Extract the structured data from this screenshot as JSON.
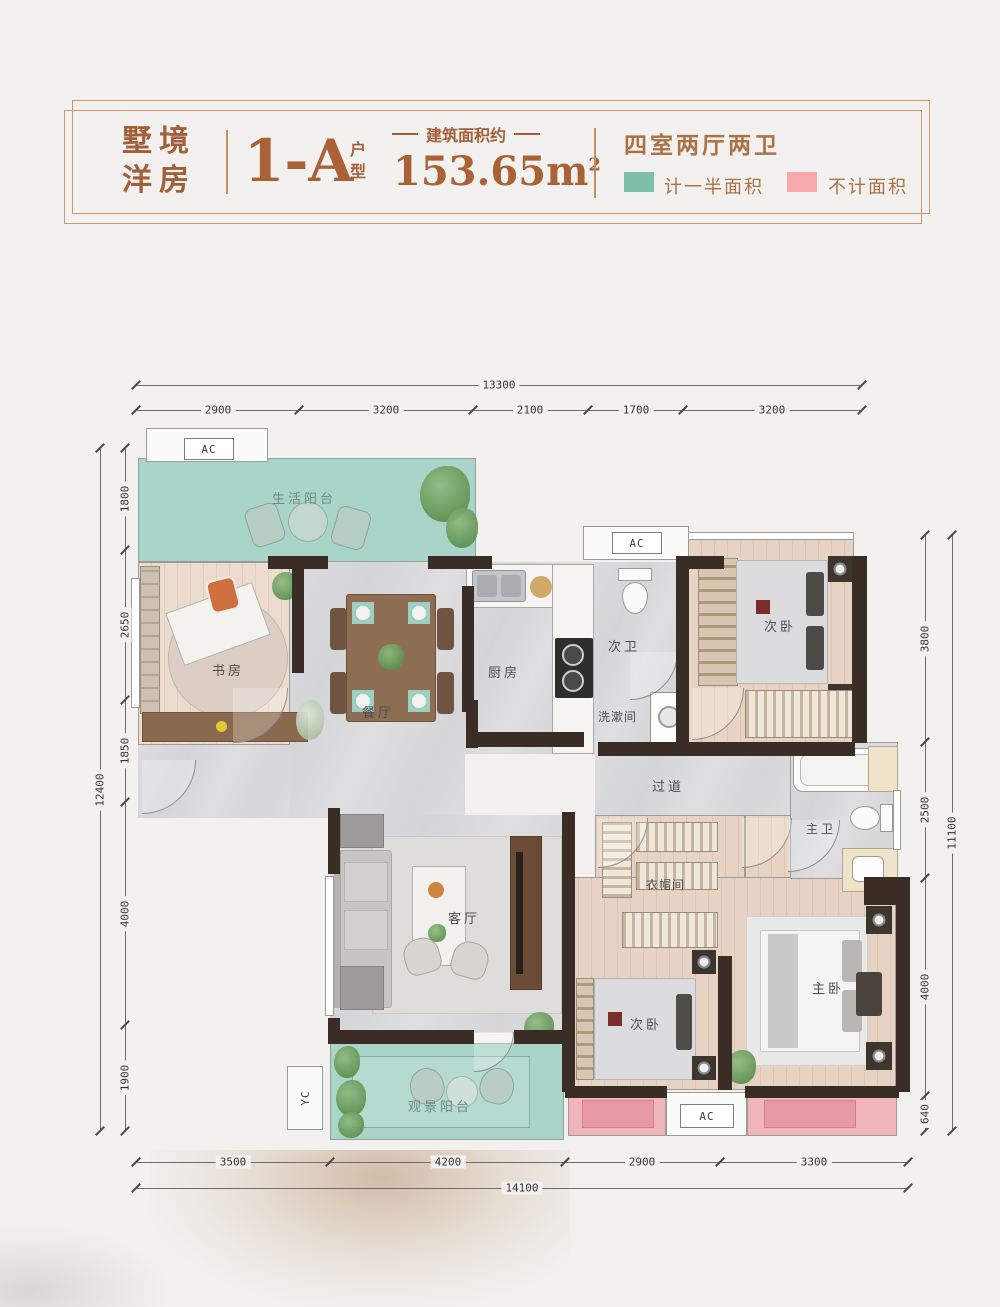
{
  "header": {
    "brand_line1": "墅境",
    "brand_line2": "洋房",
    "unit_code": "1-A",
    "unit_char1": "户",
    "unit_char2": "型",
    "area_label": "建筑面积约",
    "area_value": "153.65m",
    "area_sup": "2",
    "rooms_summary": "四室两厅两卫",
    "legend_half": {
      "label": "计一半面积",
      "color": "#7dbfa8"
    },
    "legend_excluded": {
      "label": "不计面积",
      "color": "#f5a9ab"
    }
  },
  "plan": {
    "colors": {
      "balcony": "#a9d4c8",
      "bay_window": "#efb5bb",
      "wall": "#3a2d26"
    },
    "rooms": {
      "life_balcony": "生活阳台",
      "study": "书房",
      "dining": "餐厅",
      "kitchen": "厨房",
      "second_bath": "次卫",
      "washroom": "洗漱间",
      "second_bedroom_top": "次卧",
      "corridor": "过道",
      "master_bath": "主卫",
      "cloakroom": "衣帽间",
      "living": "客厅",
      "view_balcony": "观景阳台",
      "second_bedroom_bottom": "次卧",
      "master_bedroom": "主卧"
    },
    "markers": {
      "ac": "AC",
      "yc": "YC"
    },
    "dims": {
      "top": {
        "total": "13300",
        "segments": [
          "2900",
          "3200",
          "2100",
          "1700",
          "3200"
        ]
      },
      "bottom": {
        "total": "14100",
        "segments": [
          "3500",
          "4200",
          "2900",
          "3300"
        ]
      },
      "left": {
        "total": "12400",
        "segments": [
          "1800",
          "2650",
          "1850",
          "4000",
          "1900"
        ]
      },
      "right": {
        "total": "11100",
        "segments": [
          "3800",
          "2500",
          "4000",
          "640"
        ]
      }
    }
  }
}
